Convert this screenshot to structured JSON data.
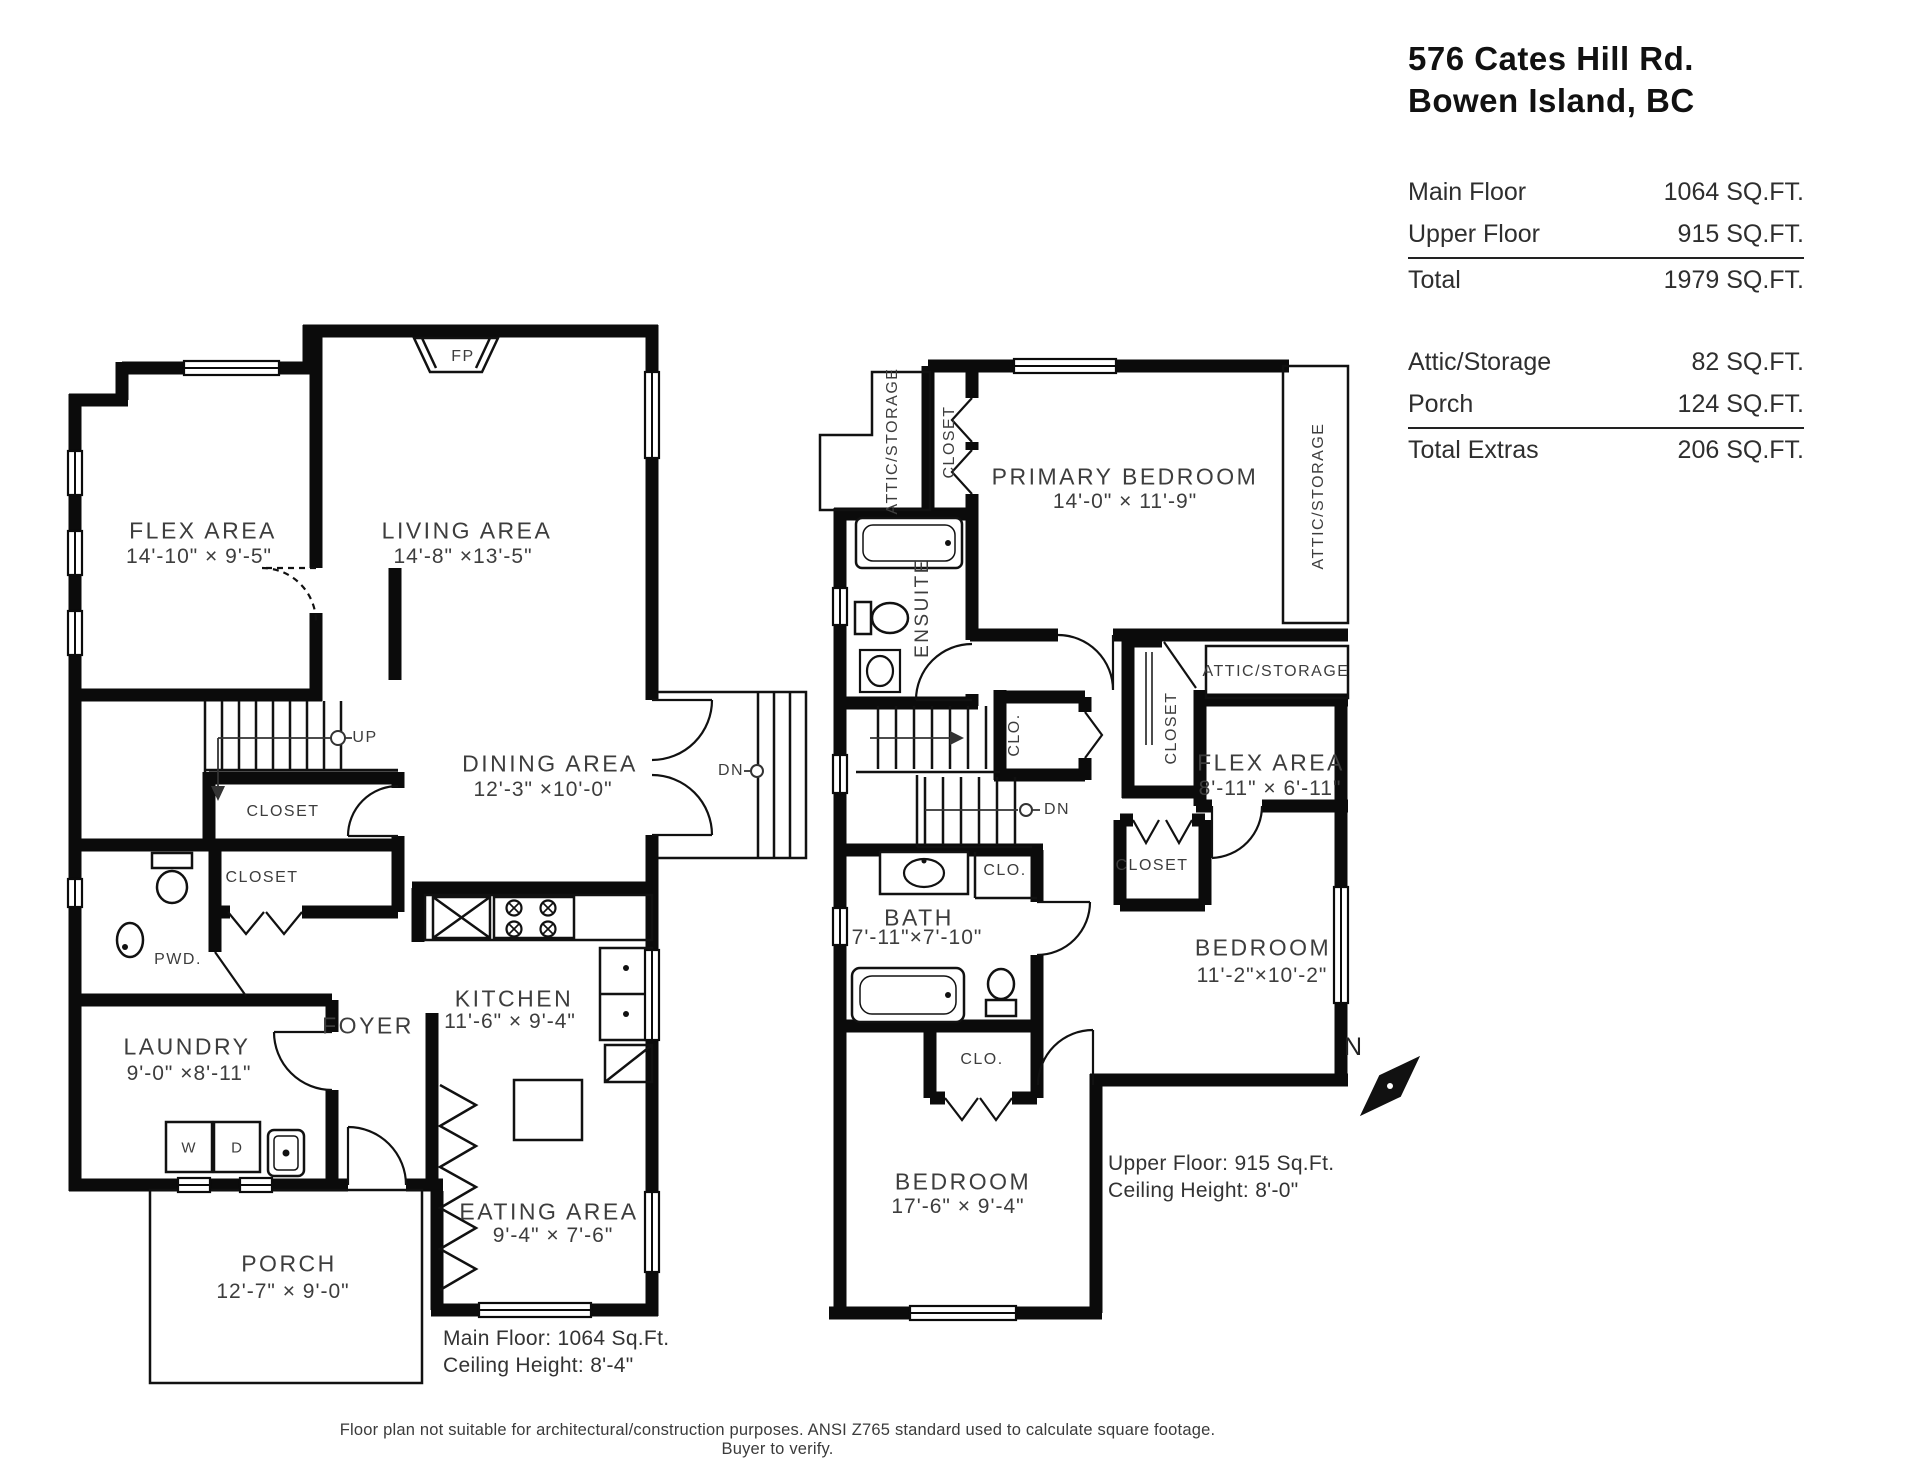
{
  "title_block": {
    "address_line1": "576 Cates Hill Rd.",
    "address_line2": "Bowen Island, BC",
    "rows_main": [
      {
        "label": "Main Floor",
        "value": "1064 SQ.FT."
      },
      {
        "label": "Upper Floor",
        "value": "915 SQ.FT."
      }
    ],
    "total": {
      "label": "Total",
      "value": "1979 SQ.FT."
    },
    "rows_extras": [
      {
        "label": "Attic/Storage",
        "value": "82 SQ.FT."
      },
      {
        "label": "Porch",
        "value": "124 SQ.FT."
      }
    ],
    "total_extras": {
      "label": "Total Extras",
      "value": "206 SQ.FT."
    }
  },
  "main_floor": {
    "flex": {
      "name": "FLEX AREA",
      "dims": "14'-10\"  × 9'-5\""
    },
    "living": {
      "name": "LIVING AREA",
      "dims": "14'-8\"  ×13'-5\""
    },
    "dining": {
      "name": "DINING AREA",
      "dims": "12'-3\"  ×10'-0\""
    },
    "kitchen": {
      "name": "KITCHEN",
      "dims": "11'-6\"  × 9'-4\""
    },
    "eating": {
      "name": "EATING AREA",
      "dims": "9'-4\" × 7'-6\""
    },
    "laundry": {
      "name": "LAUNDRY",
      "dims": "9'-0\" ×8'-11\""
    },
    "foyer": {
      "name": "FOYER"
    },
    "porch": {
      "name": "PORCH",
      "dims": "12'-7\"  × 9'-0\""
    },
    "pwd": "PWD.",
    "closet1": "CLOSET",
    "closet2": "CLOSET",
    "up": "UP",
    "dn": "DN",
    "fp": "FP",
    "washer": "W",
    "dryer": "D",
    "note_line1": "Main Floor: 1064 Sq.Ft.",
    "note_line2": "Ceiling Height: 8'-4\""
  },
  "upper_floor": {
    "primary": {
      "name": "PRIMARY BEDROOM",
      "dims": "14'-0\"  × 11'-9\""
    },
    "ensuite": "ENSUITE",
    "attic_left": "ATTIC/STORAGE",
    "attic_right": "ATTIC/STORAGE",
    "attic_mid": "ATTIC/STORAGE",
    "closet_top": "CLOSET",
    "closet_mid": "CLOSET",
    "closet_bedroom": "CLOSET",
    "clo_hall": "CLO.",
    "clo_bath": "CLO.",
    "clo_bedroom": "CLO.",
    "flex": {
      "name": "FLEX AREA",
      "dims": "8'-11\"  × 6'-11\""
    },
    "bath": {
      "name": "BATH",
      "dims": "7'-11\"×7'-10\""
    },
    "bedroom_right": {
      "name": "BEDROOM",
      "dims": "11'-2\"×10'-2\""
    },
    "bedroom_bottom": {
      "name": "BEDROOM",
      "dims": "17'-6\"  × 9'-4\""
    },
    "dn": "DN",
    "note_line1": "Upper Floor: 915 Sq.Ft.",
    "note_line2": "Ceiling Height: 8'-0\""
  },
  "compass": {
    "north": "N"
  },
  "disclaimer": "Floor plan not suitable for architectural/construction purposes. ANSI Z765 standard used to calculate square footage. Buyer to verify."
}
